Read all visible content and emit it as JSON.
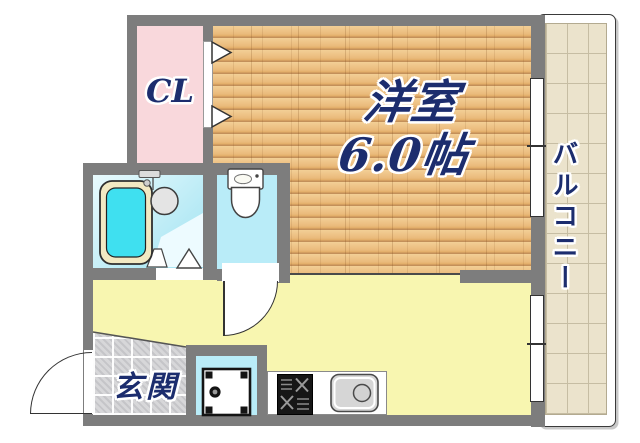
{
  "floorplan": {
    "title": "ワンルーム間取り図",
    "labels": {
      "closet": "CL",
      "room_name": "洋室",
      "room_size": "6.0帖",
      "balcony": "バルコニー",
      "entrance": "玄関"
    },
    "rooms": [
      {
        "name": "western-room",
        "label": "洋室 6.0帖",
        "floor": "wood"
      },
      {
        "name": "closet",
        "label": "CL",
        "floor": "pink"
      },
      {
        "name": "kitchen",
        "label": "",
        "floor": "yellow"
      },
      {
        "name": "entrance",
        "label": "玄関",
        "floor": "gray-tile"
      },
      {
        "name": "bathroom",
        "label": "",
        "floor": "cyan"
      },
      {
        "name": "toilet-room",
        "label": "",
        "floor": "cyan"
      },
      {
        "name": "washer-space",
        "label": "",
        "floor": "cyan"
      },
      {
        "name": "balcony",
        "label": "バルコニー",
        "floor": "beige-tile"
      }
    ],
    "fixtures": [
      "bathtub",
      "washbasin",
      "toilet",
      "washing-machine-pan",
      "gas-stove",
      "kitchen-sink"
    ],
    "doors": [
      "entrance-swing-door",
      "toilet-swing-door",
      "closet-folding-door",
      "bathroom-folding-door"
    ],
    "windows": [
      "room-balcony-window",
      "kitchen-balcony-window"
    ],
    "colors": {
      "wall": "#7d7d7d",
      "label_navy": "#1c2d6e",
      "wood_floor": "#e2ad67",
      "closet_pink": "#f9d8dc",
      "kitchen_yellow": "#f8f6b0",
      "bath_cyan": "#b9ecf8",
      "tub_cyan": "#3fe0f0",
      "balcony_tile": "#ebe3cc",
      "entrance_tile": "#d7d7d9"
    }
  }
}
